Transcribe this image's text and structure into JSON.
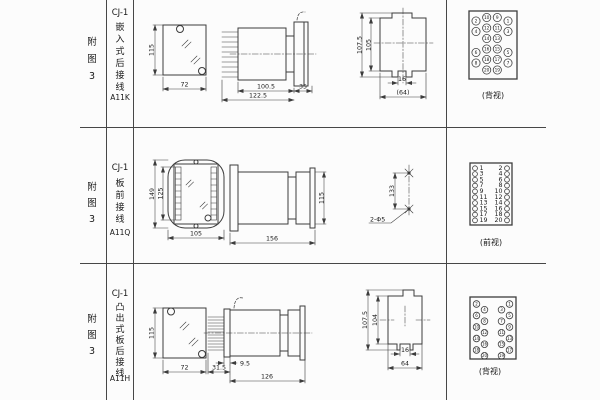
{
  "rows": [
    {
      "ref": "附\n图\n3",
      "model": "CJ-1",
      "type": "嵌\n入\n式\n后\n接\n线",
      "code": "A11K",
      "cutout": {
        "h": "115",
        "w": "72"
      },
      "side": {
        "body": "100.5",
        "total": "122.5",
        "flange": "35"
      },
      "rear": {
        "h_outer": "107.5",
        "h_inner": "105",
        "w_slot": "16",
        "w_total": "(64)"
      },
      "terms": {
        "label": "(背视)",
        "inner_left": [
          "10",
          "12",
          "14",
          "16",
          "18",
          "20"
        ],
        "inner_right": [
          "9",
          "11",
          "13",
          "15",
          "17",
          "19"
        ],
        "outer_left": [
          "2",
          "4",
          "6",
          "8"
        ],
        "outer_right": [
          "1",
          "3",
          "5",
          "7"
        ]
      }
    },
    {
      "ref": "附\n图\n3",
      "model": "CJ-1",
      "type": "板\n前\n接\n线",
      "code": "A11Q",
      "front": {
        "h_outer": "149",
        "h_inner": "125",
        "w": "105"
      },
      "side": {
        "total": "156",
        "h": "115"
      },
      "drill": {
        "spacing": "133",
        "holes": "2-Φ5"
      },
      "terms": {
        "label": "(前视)",
        "left": [
          "1",
          "3",
          "5",
          "7",
          "9",
          "11",
          "13",
          "15",
          "17",
          "19"
        ],
        "right": [
          "2",
          "4",
          "6",
          "8",
          "10",
          "12",
          "14",
          "16",
          "18",
          "20"
        ]
      }
    },
    {
      "ref": "附\n图\n3",
      "model": "CJ-1",
      "type": "凸\n出\n式\n板\n后\n接\n线",
      "code": "A11H",
      "cutout": {
        "h": "115",
        "w": "72"
      },
      "side": {
        "comb": "31.5",
        "plate": "9.5",
        "body": "126"
      },
      "rear": {
        "h_outer": "107.5",
        "h_inner": "104",
        "w_slot": "16",
        "w_total": "64"
      },
      "terms": {
        "label": "(背视)",
        "outer_left": [
          "2",
          "6",
          "10",
          "14",
          "18"
        ],
        "inner_left": [
          "4",
          "8",
          "12",
          "16",
          "20"
        ],
        "inner_right": [
          "3",
          "7",
          "11",
          "15",
          "19"
        ],
        "outer_right": [
          "1",
          "5",
          "9",
          "13",
          "17"
        ]
      }
    }
  ]
}
